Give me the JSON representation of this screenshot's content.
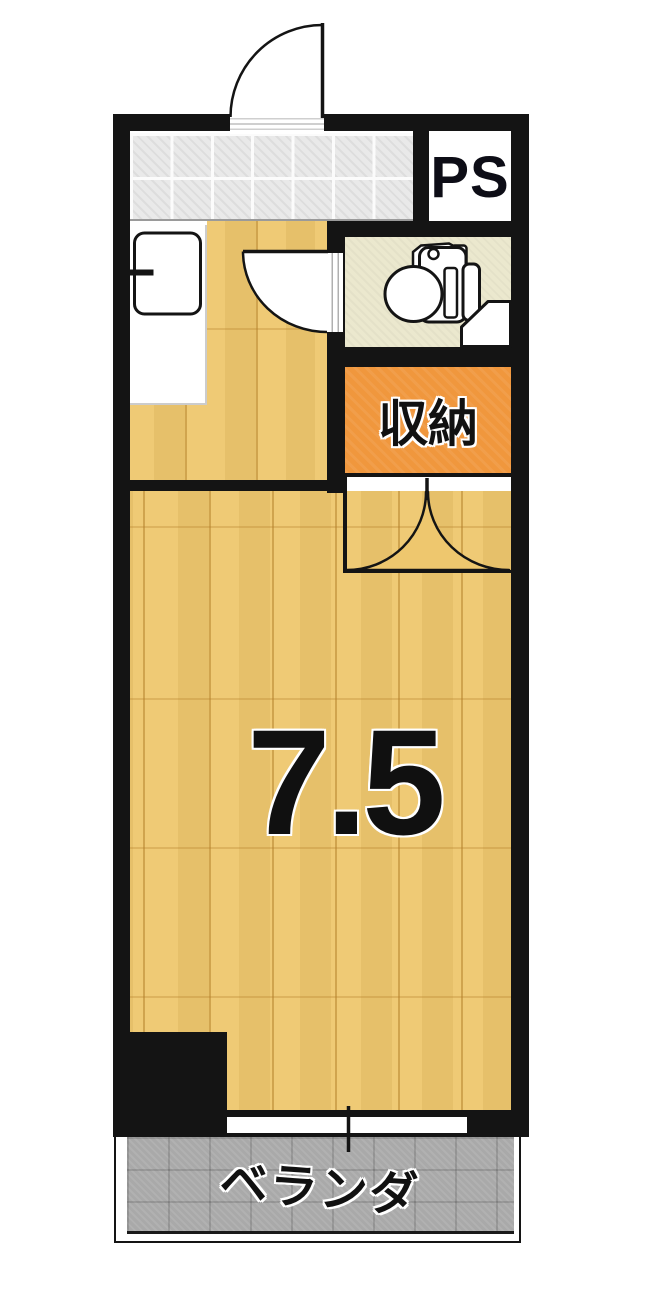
{
  "plan": {
    "type": "apartment-floorplan",
    "labels": {
      "pipe_space": "PS",
      "storage": "収納",
      "main_room_size": "7.5",
      "veranda": "ベランダ"
    },
    "colors": {
      "wall": "#141414",
      "wood_floor": "#eec76e",
      "wood_grain": "#b27d28",
      "tile_floor": "#e9e9e9",
      "toilet_floor": "#ebe8ce",
      "storage_fill": "#f0973d",
      "veranda_fill": "#a9a9a9",
      "background": "#ffffff"
    }
  }
}
